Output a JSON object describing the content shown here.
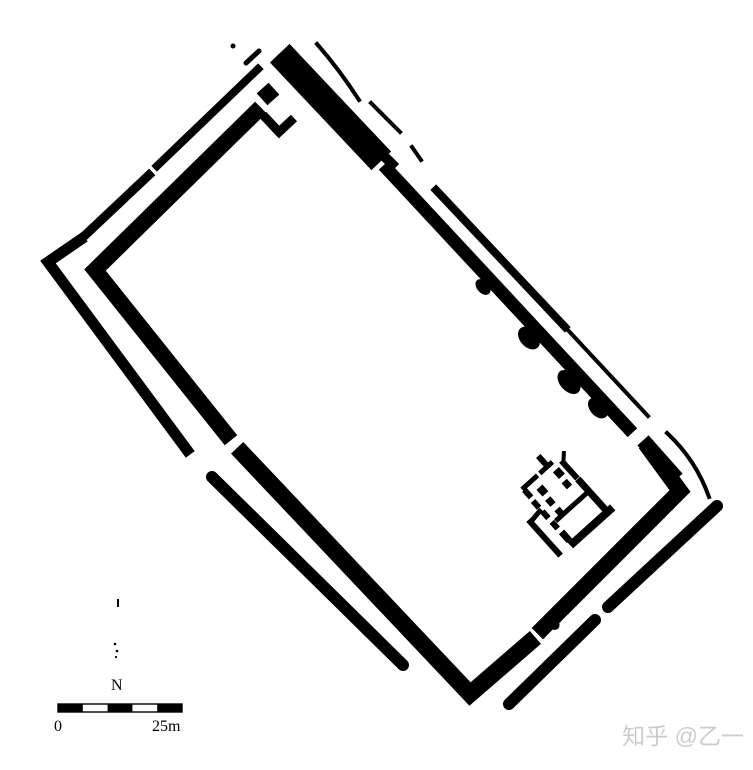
{
  "canvas": {
    "width": 753,
    "height": 770,
    "background": "#ffffff",
    "ink": "#000000"
  },
  "plan": {
    "kind": "walled-enclosure-site-plan",
    "features": [
      "double rampart rectangular enclosure",
      "gate break at north corner",
      "wall breaches on south-west and south-east sides",
      "small multi-room building inside east corner"
    ]
  },
  "north_arrow": {
    "label": "N"
  },
  "scale_bar": {
    "zero_label": "0",
    "end_label": "25m",
    "segments": 5
  },
  "watermark": {
    "text": "知乎 @乙一",
    "color": "#cccccc"
  }
}
